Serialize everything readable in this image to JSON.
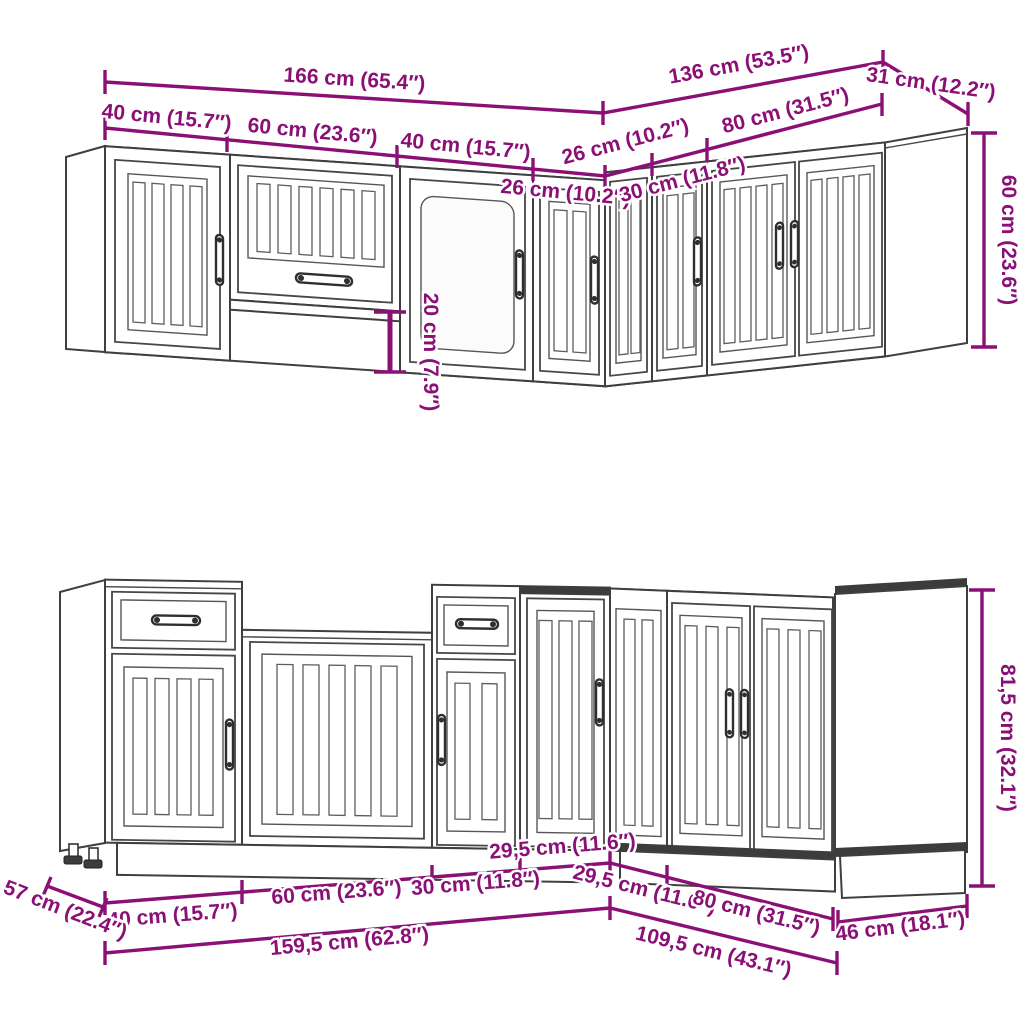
{
  "colors": {
    "dimension": "#8A1076",
    "line_art": "#3f3f3f",
    "background": "#ffffff"
  },
  "upper_row": {
    "total_left": "166 cm (65.4″)",
    "total_right": "136 cm (53.5″)",
    "depth_right": "31 cm (12.2″)",
    "segments_left": [
      "40 cm (15.7″)",
      "60 cm (23.6″)",
      "40 cm (15.7″)",
      "26 cm (10.2″)"
    ],
    "segments_right": [
      "26 cm (10.2″)",
      "30 cm (11.8″)",
      "80 cm (31.5″)"
    ],
    "height_right": "60 cm (23.6″)",
    "bridge_drop": "20 cm (7.9″)"
  },
  "lower_row": {
    "segments_left": [
      "40 cm (15.7″)",
      "60 cm (23.6″)",
      "30 cm (11.8″)",
      "29,5 cm (11.6″)"
    ],
    "segments_right": [
      "29,5 cm (11.6″)",
      "80 cm (31.5″)"
    ],
    "total_left": "159,5 cm (62.8″)",
    "total_right": "109,5 cm (43.1″)",
    "depth_left": "57 cm (22.4″)",
    "depth_right": "46 cm (18.1″)",
    "height_right": "81,5 cm (32.1″)"
  }
}
